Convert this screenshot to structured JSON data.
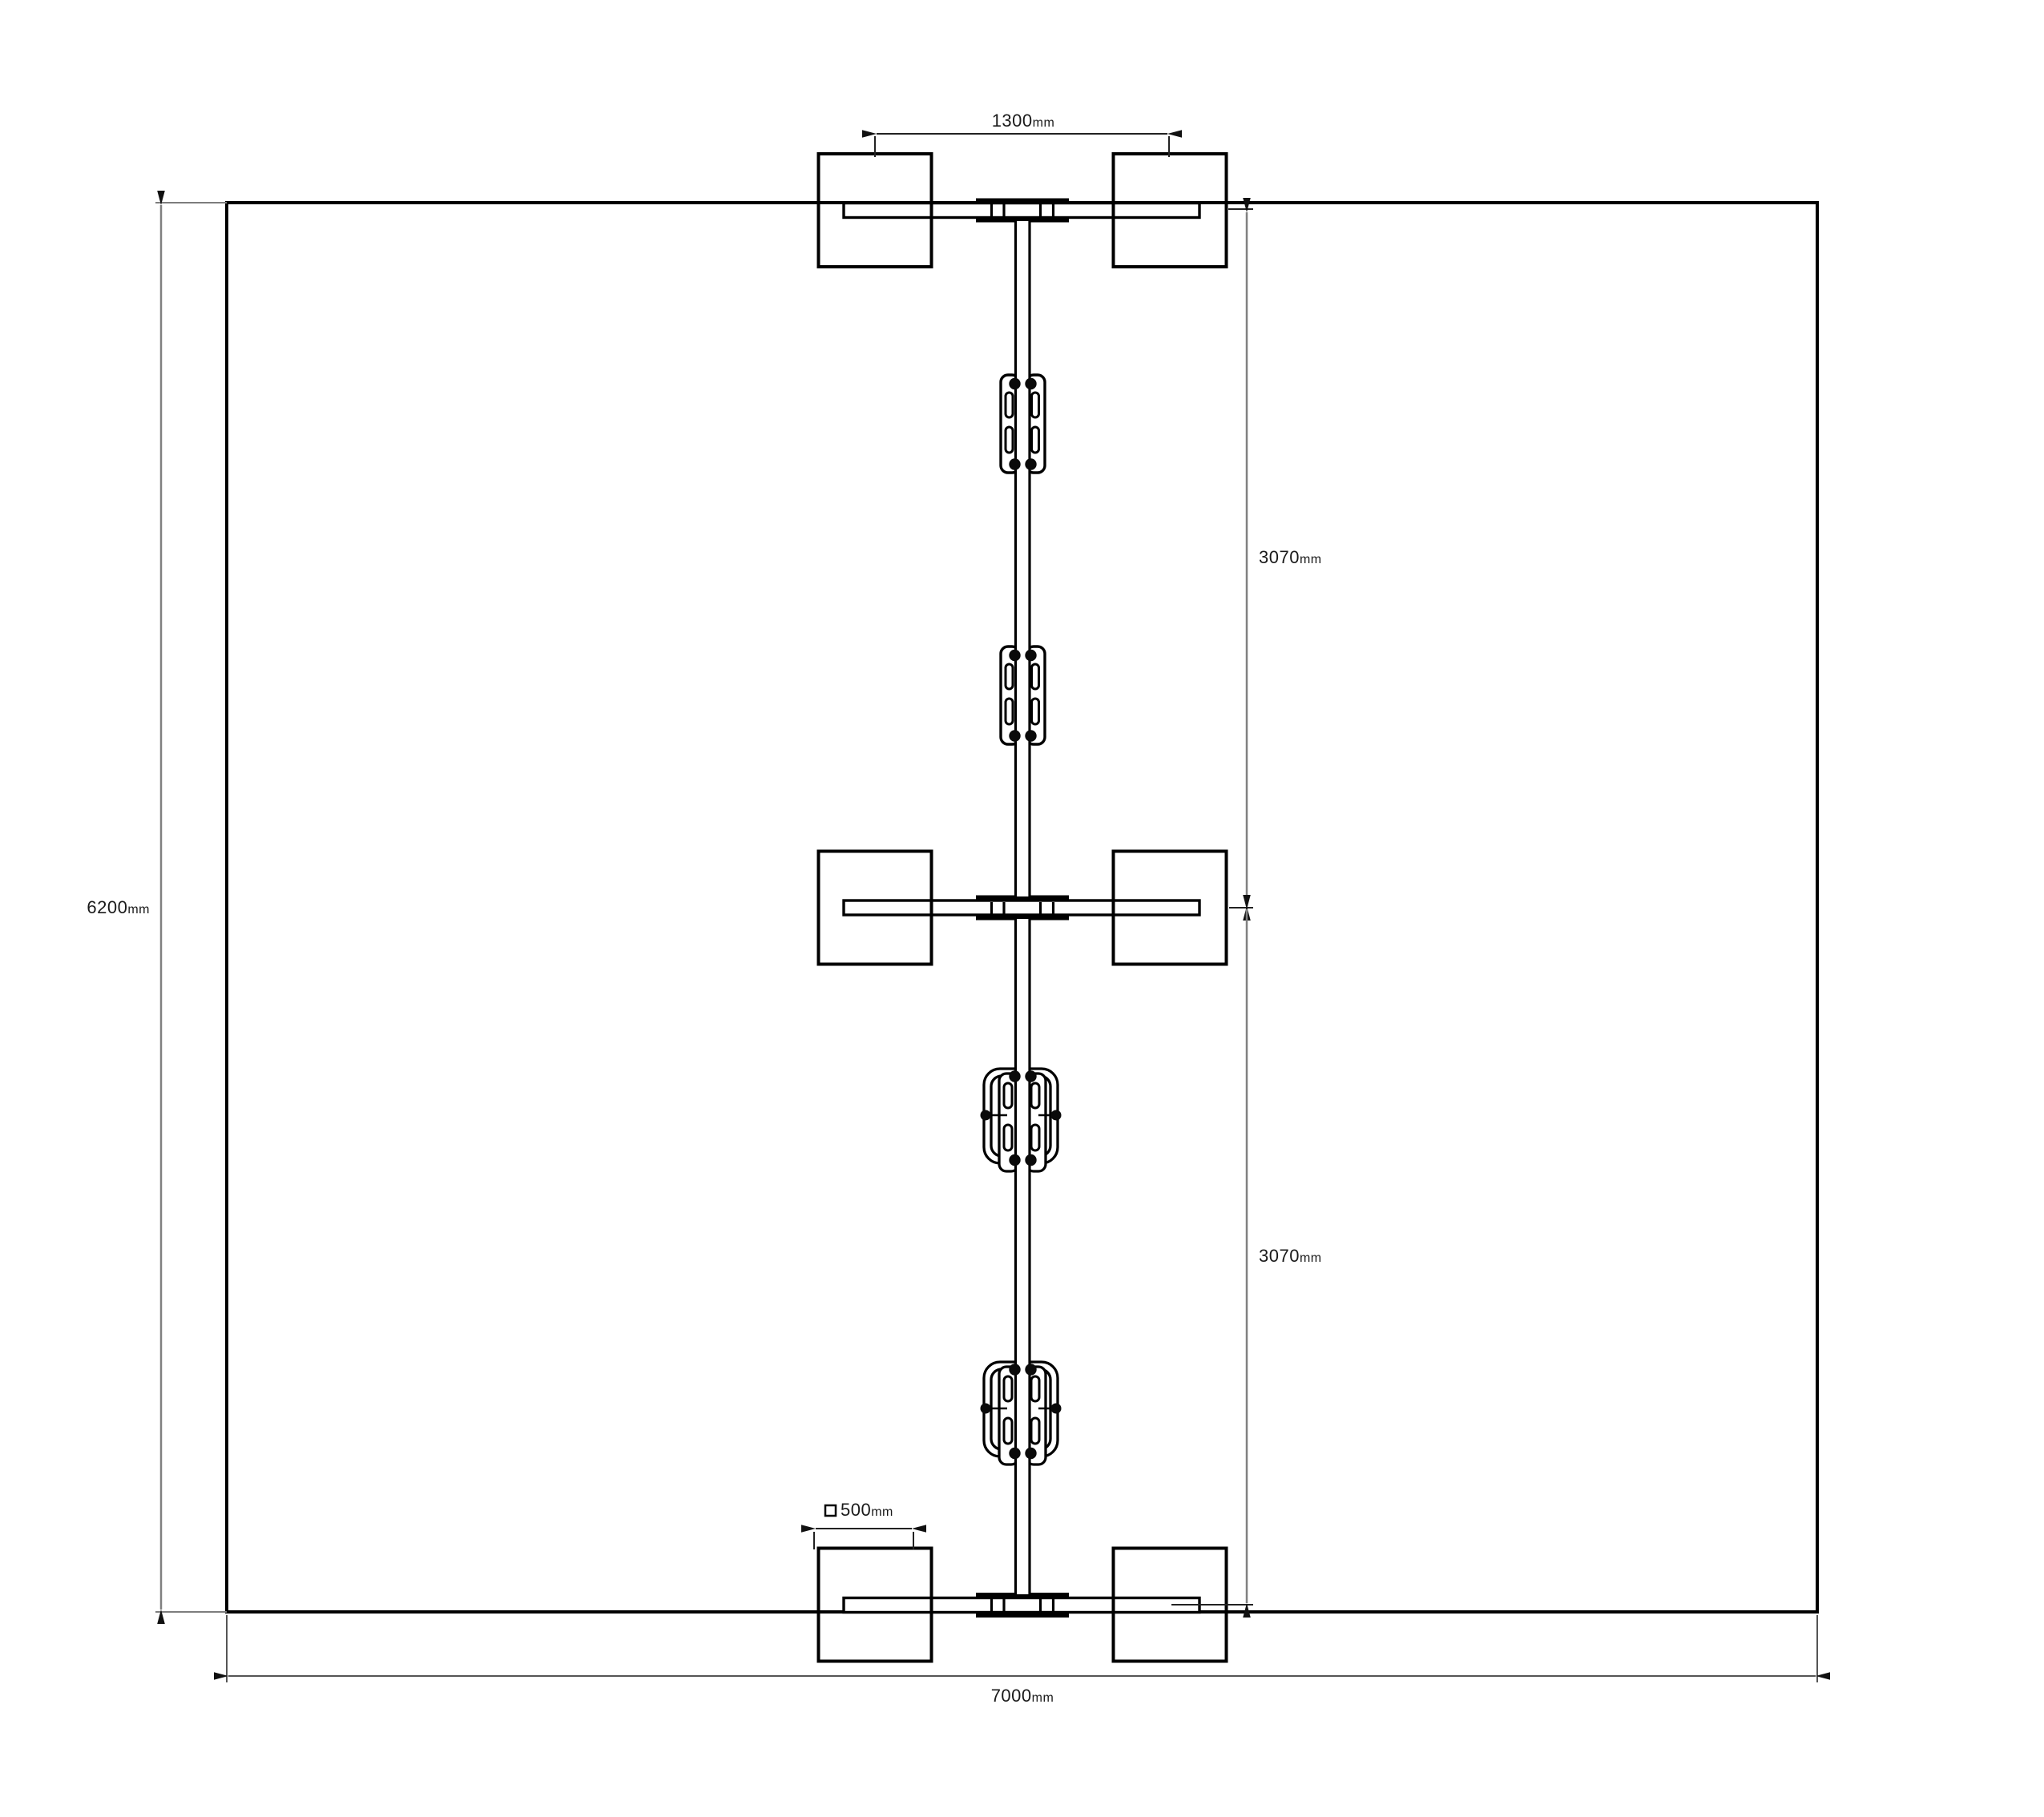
{
  "drawing": {
    "background_color": "#ffffff",
    "line_color": "#000000",
    "dimension_line_color": "#808080"
  },
  "dimensions": {
    "top_spacing": {
      "value": "1300",
      "unit": "mm"
    },
    "overall_height": {
      "value": "6200",
      "unit": "mm"
    },
    "upper_bay": {
      "value": "3070",
      "unit": "mm"
    },
    "lower_bay": {
      "value": "3070",
      "unit": "mm"
    },
    "overall_width": {
      "value": "7000",
      "unit": "mm"
    },
    "pad_size": {
      "value": "500",
      "unit": "mm"
    }
  }
}
